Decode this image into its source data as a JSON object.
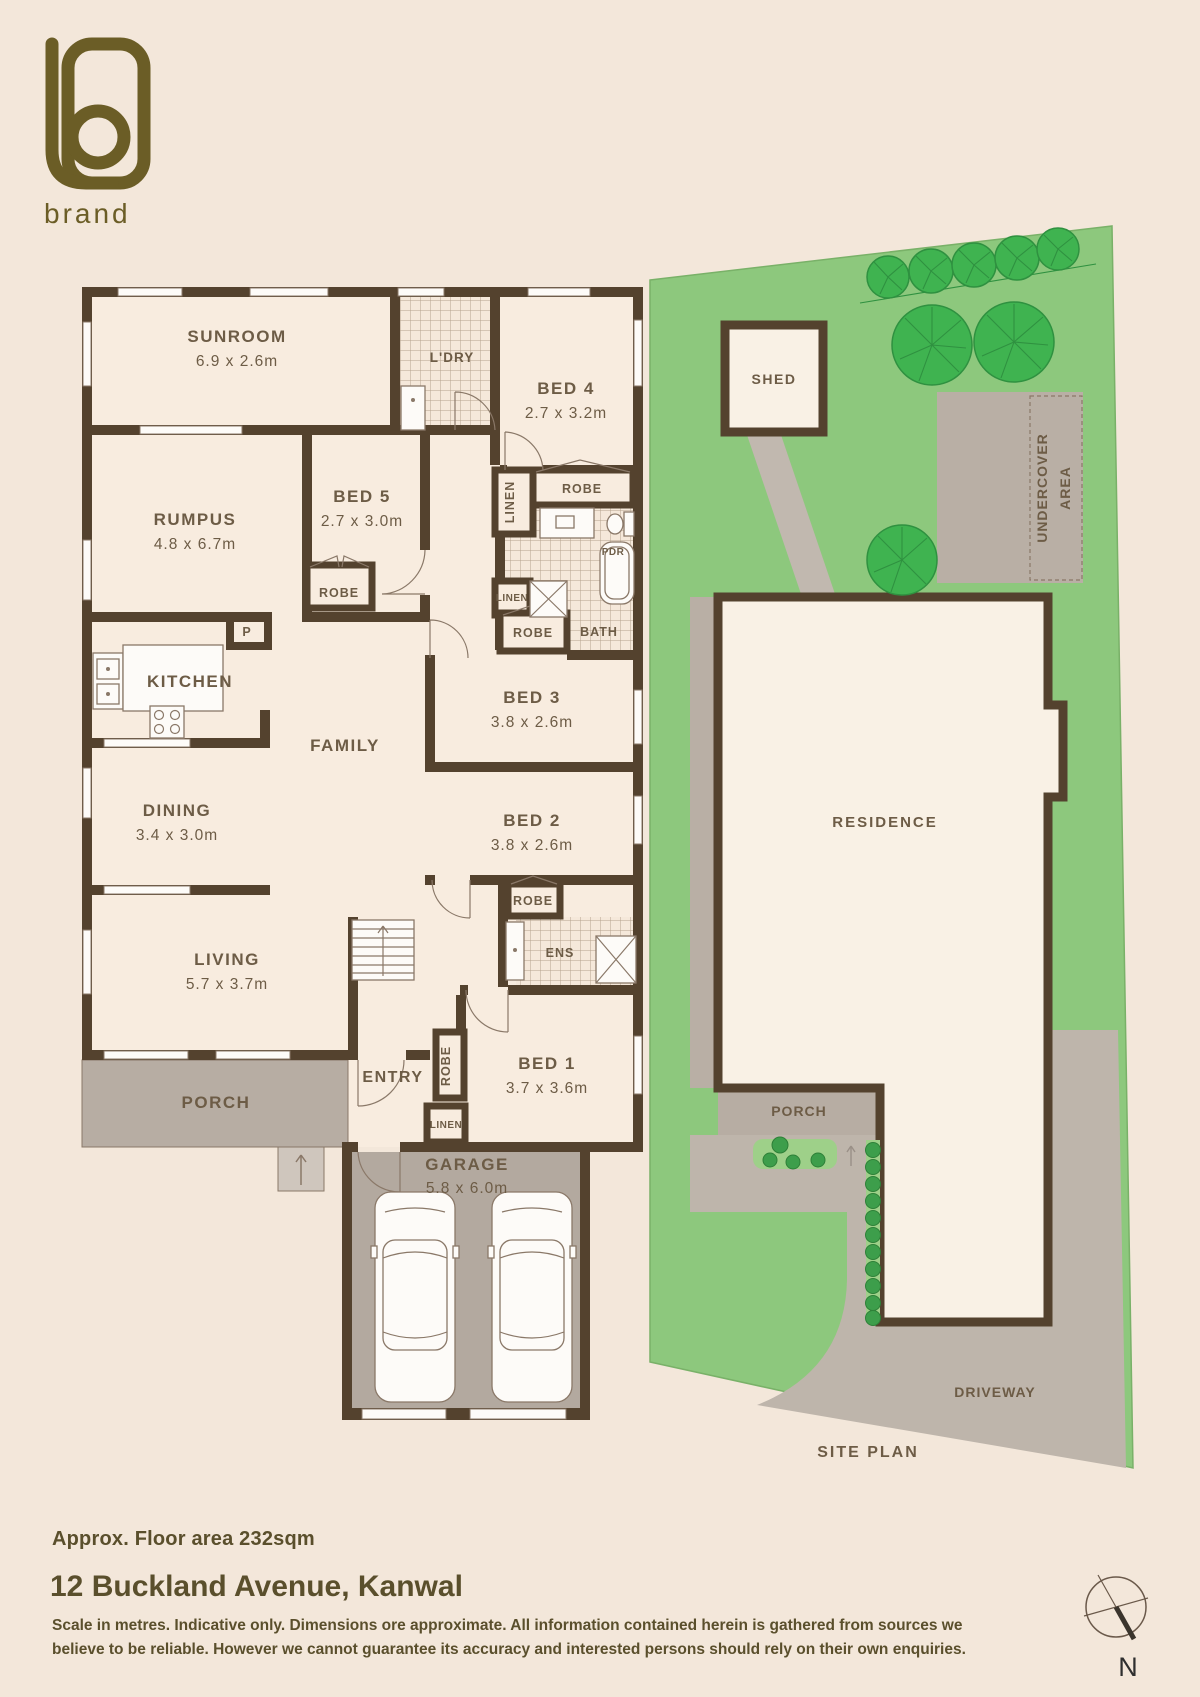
{
  "brand": {
    "name": "brand"
  },
  "floorplan": {
    "sunroom": {
      "name": "SUNROOM",
      "dims": "6.9 x 2.6m"
    },
    "ldry": {
      "name": "L'DRY"
    },
    "bed4": {
      "name": "BED 4",
      "dims": "2.7 x 3.2m"
    },
    "rumpus": {
      "name": "RUMPUS",
      "dims": "4.8 x 6.7m"
    },
    "bed5": {
      "name": "BED 5",
      "dims": "2.7 x 3.0m"
    },
    "bed3": {
      "name": "BED 3",
      "dims": "3.8 x 2.6m"
    },
    "bed2": {
      "name": "BED 2",
      "dims": "3.8 x 2.6m"
    },
    "bed1": {
      "name": "BED 1",
      "dims": "3.7 x 3.6m"
    },
    "dining": {
      "name": "DINING",
      "dims": "3.4 x 3.0m"
    },
    "living": {
      "name": "LIVING",
      "dims": "5.7 x 3.7m"
    },
    "garage": {
      "name": "GARAGE",
      "dims": "5.8 x 6.0m"
    },
    "kitchen": {
      "name": "KITCHEN"
    },
    "family": {
      "name": "FAMILY"
    },
    "entry": {
      "name": "ENTRY"
    },
    "porch": {
      "name": "PORCH"
    },
    "robe": "ROBE",
    "linen": "LINEN",
    "bath": "BATH",
    "ens": "ENS",
    "pdr": "PDR",
    "pantry": "P"
  },
  "siteplan": {
    "shed": "SHED",
    "undercover_line1": "UNDERCOVER",
    "undercover_line2": "AREA",
    "residence": "RESIDENCE",
    "porch": "PORCH",
    "driveway": "DRIVEWAY",
    "caption": "SITE PLAN"
  },
  "footer": {
    "floor_area": "Approx. Floor area 232sqm",
    "address": "12 Buckland Avenue, Kanwal",
    "disclaimer_line1": "Scale in metres. Indicative only. Dimensions ore approximate. All information contained herein is gathered from sources we",
    "disclaimer_line2": "believe to be reliable. However we cannot guarantee its accuracy and interested persons should rely on their own enquiries.",
    "compass_north": "N"
  },
  "colors": {
    "background": "#f3e7da",
    "wall_brown": "#54422e",
    "room_fill": "#f8ecdf",
    "label_brown": "#6d5c46",
    "hardscape_gray": "#b7ada3",
    "lawn_green": "#8dc87d",
    "tree_green": "#3fb350",
    "logo_olive": "#6b5d26",
    "footer_text": "#5a4f2c"
  }
}
